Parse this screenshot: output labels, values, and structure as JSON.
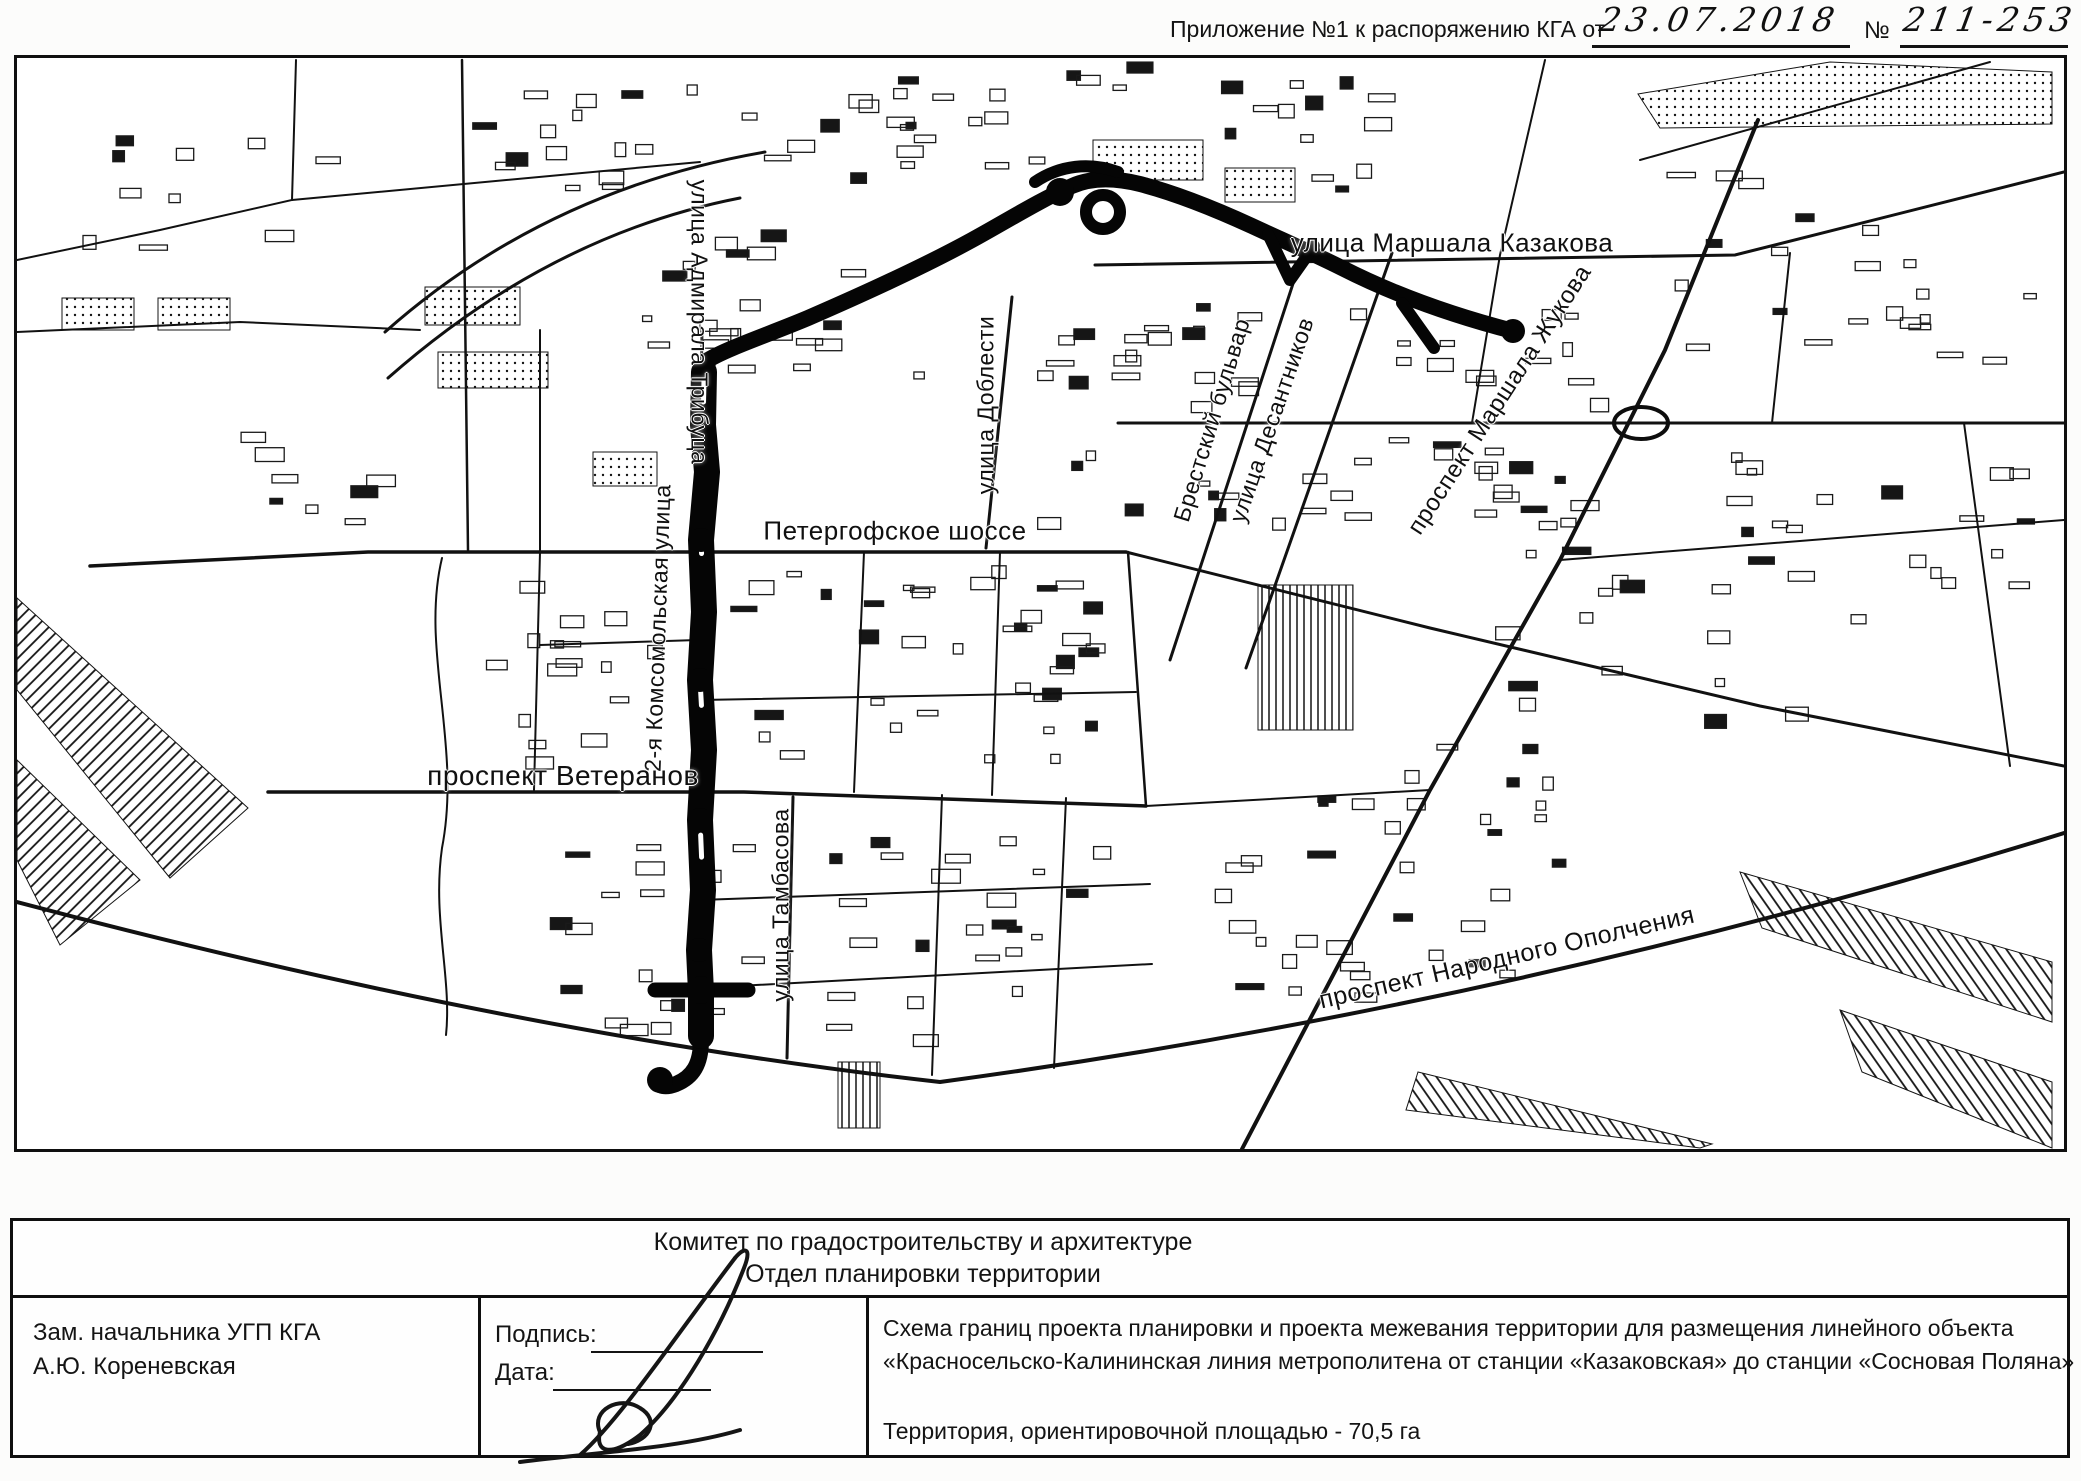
{
  "header": {
    "prefix": "Приложение №1 к распоряжению КГА от",
    "date": "23.07.2018",
    "number_sign": "№",
    "number": "211-253"
  },
  "map": {
    "street_labels": [
      {
        "name": "ulitsa-marshala-kazakova",
        "text": "улица Маршала Казакова"
      },
      {
        "name": "ulitsa-admirala-tributsa",
        "text": "улица Адмирала Трибуца"
      },
      {
        "name": "ulitsa-doblesti",
        "text": "улица Доблести"
      },
      {
        "name": "brestskiy-bulvar",
        "text": "Брестский бульвар"
      },
      {
        "name": "ulitsa-desantnikov",
        "text": "улица Десантников"
      },
      {
        "name": "prospekt-marshala-zhukova",
        "text": "проспект Маршала Жукова"
      },
      {
        "name": "petergofskoe-shosse",
        "text": "Петергофское шоссе"
      },
      {
        "name": "komsomolskaya-ulitsa",
        "text": "2-я Комсомольская улица"
      },
      {
        "name": "prospekt-veteranov",
        "text": "проспект Ветеранов"
      },
      {
        "name": "ulitsa-tambasova",
        "text": "улица Тамбасова"
      },
      {
        "name": "prospekt-narodnogo-opolcheniya",
        "text": "проспект Народного Ополчения"
      }
    ]
  },
  "title_block": {
    "org_line1": "Комитет по градостроительству и архитектуре",
    "org_line2": "Отдел планировки территории",
    "official_position": "Зам. начальника УГП КГА",
    "official_name": "А.Ю. Кореневская",
    "signature_label": "Подпись:",
    "date_label": "Дата:",
    "description_line1": "Схема границ проекта планировки и проекта межевания территории для размещения линейного объекта",
    "description_line2": "«Красносельско-Калининская линия метрополитена от станции «Казаковская» до станции «Сосновая Поляна»",
    "area_note": "Территория, ориентировочной площадью - 70,5 га"
  }
}
